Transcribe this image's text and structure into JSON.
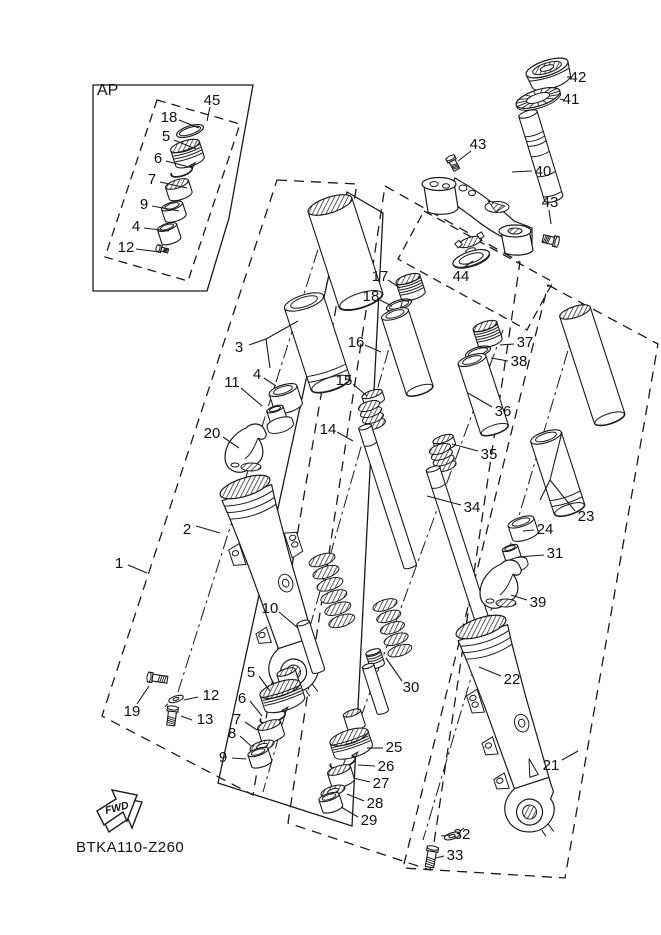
{
  "diagram": {
    "code": "BTKA110-Z260",
    "ap_label": "AP",
    "fwd_label": "FWD",
    "background_color": "#ffffff",
    "line_color": "#1a1a1a",
    "callouts": [
      {
        "n": "45",
        "x": 212,
        "y": 100,
        "leaders": [
          [
            210,
            107,
            207,
            121
          ]
        ]
      },
      {
        "n": "18",
        "x": 169,
        "y": 117,
        "leaders": [
          [
            179,
            120,
            199,
            128
          ]
        ]
      },
      {
        "n": "5",
        "x": 166,
        "y": 136,
        "leaders": [
          [
            174,
            140,
            196,
            149
          ]
        ]
      },
      {
        "n": "6",
        "x": 158,
        "y": 158,
        "leaders": [
          [
            166,
            161,
            193,
            168
          ]
        ]
      },
      {
        "n": "7",
        "x": 152,
        "y": 179,
        "leaders": [
          [
            160,
            182,
            187,
            188
          ]
        ]
      },
      {
        "n": "9",
        "x": 144,
        "y": 204,
        "leaders": [
          [
            152,
            206,
            179,
            211
          ]
        ]
      },
      {
        "n": "4",
        "x": 136,
        "y": 226,
        "leaders": [
          [
            144,
            228,
            169,
            231
          ]
        ]
      },
      {
        "n": "12",
        "x": 126,
        "y": 247,
        "leaders": [
          [
            136,
            249,
            160,
            252
          ]
        ]
      },
      {
        "n": "42",
        "x": 578,
        "y": 77,
        "leaders": [
          [
            567,
            77,
            572,
            77
          ]
        ]
      },
      {
        "n": "41",
        "x": 571,
        "y": 99,
        "leaders": [
          [
            560,
            99,
            564,
            100
          ]
        ]
      },
      {
        "n": "43",
        "x": 478,
        "y": 144,
        "leaders": [
          [
            471,
            151,
            458,
            161
          ]
        ]
      },
      {
        "n": "40",
        "x": 543,
        "y": 171,
        "leaders": [
          [
            532,
            171,
            512,
            172
          ]
        ]
      },
      {
        "n": "43",
        "x": 550,
        "y": 202,
        "leaders": [
          [
            549,
            210,
            551,
            224
          ]
        ]
      },
      {
        "n": "44",
        "x": 461,
        "y": 276,
        "leaders": [
          [
            463,
            268,
            473,
            261
          ]
        ]
      },
      {
        "n": "17",
        "x": 380,
        "y": 276,
        "leaders": [
          [
            388,
            280,
            400,
            288
          ]
        ]
      },
      {
        "n": "18",
        "x": 371,
        "y": 296,
        "leaders": [
          [
            380,
            300,
            392,
            306
          ]
        ]
      },
      {
        "n": "16",
        "x": 356,
        "y": 342,
        "leaders": [
          [
            365,
            345,
            381,
            352
          ]
        ]
      },
      {
        "n": "3",
        "x": 239,
        "y": 347,
        "leaders": [
          [
            249,
            345,
            266,
            339
          ],
          [
            266,
            339,
            298,
            321
          ],
          [
            266,
            339,
            270,
            368
          ]
        ]
      },
      {
        "n": "4",
        "x": 257,
        "y": 374,
        "leaders": [
          [
            264,
            378,
            276,
            386
          ]
        ]
      },
      {
        "n": "11",
        "x": 232,
        "y": 382,
        "leaders": [
          [
            241,
            388,
            262,
            406
          ]
        ]
      },
      {
        "n": "15",
        "x": 344,
        "y": 380,
        "leaders": [
          [
            353,
            384,
            367,
            396
          ]
        ]
      },
      {
        "n": "14",
        "x": 328,
        "y": 429,
        "leaders": [
          [
            337,
            432,
            353,
            441
          ]
        ]
      },
      {
        "n": "20",
        "x": 212,
        "y": 433,
        "leaders": [
          [
            223,
            437,
            239,
            448
          ]
        ]
      },
      {
        "n": "2",
        "x": 187,
        "y": 529,
        "leaders": [
          [
            196,
            526,
            220,
            533
          ]
        ]
      },
      {
        "n": "1",
        "x": 119,
        "y": 563,
        "leaders": [
          [
            128,
            565,
            147,
            573
          ]
        ]
      },
      {
        "n": "10",
        "x": 270,
        "y": 608,
        "leaders": [
          [
            279,
            612,
            298,
            628
          ]
        ]
      },
      {
        "n": "37",
        "x": 525,
        "y": 342,
        "leaders": [
          [
            514,
            344,
            500,
            345
          ]
        ]
      },
      {
        "n": "38",
        "x": 519,
        "y": 361,
        "leaders": [
          [
            508,
            361,
            491,
            358
          ]
        ]
      },
      {
        "n": "36",
        "x": 503,
        "y": 411,
        "leaders": [
          [
            492,
            407,
            468,
            393
          ]
        ]
      },
      {
        "n": "35",
        "x": 489,
        "y": 454,
        "leaders": [
          [
            478,
            451,
            452,
            444
          ]
        ]
      },
      {
        "n": "34",
        "x": 472,
        "y": 507,
        "leaders": [
          [
            461,
            505,
            427,
            496
          ]
        ]
      },
      {
        "n": "23",
        "x": 586,
        "y": 516,
        "leaders": [
          [
            575,
            511,
            550,
            480
          ],
          [
            550,
            480,
            562,
            432
          ],
          [
            550,
            480,
            540,
            500
          ]
        ]
      },
      {
        "n": "24",
        "x": 545,
        "y": 529,
        "leaders": [
          [
            534,
            530,
            523,
            531
          ]
        ]
      },
      {
        "n": "31",
        "x": 555,
        "y": 553,
        "leaders": [
          [
            544,
            555,
            518,
            557
          ]
        ]
      },
      {
        "n": "39",
        "x": 538,
        "y": 602,
        "leaders": [
          [
            527,
            600,
            511,
            595
          ]
        ]
      },
      {
        "n": "30",
        "x": 411,
        "y": 687,
        "leaders": [
          [
            402,
            681,
            386,
            658
          ]
        ]
      },
      {
        "n": "22",
        "x": 512,
        "y": 679,
        "leaders": [
          [
            501,
            676,
            479,
            667
          ]
        ]
      },
      {
        "n": "21",
        "x": 551,
        "y": 765,
        "leaders": [
          [
            562,
            760,
            578,
            751
          ]
        ]
      },
      {
        "n": "25",
        "x": 394,
        "y": 747,
        "leaders": [
          [
            383,
            748,
            367,
            748
          ]
        ]
      },
      {
        "n": "26",
        "x": 386,
        "y": 766,
        "leaders": [
          [
            375,
            766,
            358,
            765
          ]
        ]
      },
      {
        "n": "27",
        "x": 381,
        "y": 783,
        "leaders": [
          [
            370,
            782,
            353,
            778
          ]
        ]
      },
      {
        "n": "28",
        "x": 375,
        "y": 803,
        "leaders": [
          [
            364,
            801,
            347,
            794
          ]
        ]
      },
      {
        "n": "29",
        "x": 369,
        "y": 820,
        "leaders": [
          [
            358,
            817,
            341,
            807
          ]
        ]
      },
      {
        "n": "5",
        "x": 251,
        "y": 672,
        "leaders": [
          [
            259,
            676,
            270,
            691
          ]
        ]
      },
      {
        "n": "6",
        "x": 242,
        "y": 698,
        "leaders": [
          [
            250,
            701,
            262,
            716
          ]
        ]
      },
      {
        "n": "7",
        "x": 237,
        "y": 719,
        "leaders": [
          [
            245,
            722,
            257,
            730
          ]
        ]
      },
      {
        "n": "8",
        "x": 232,
        "y": 733,
        "leaders": [
          [
            240,
            736,
            251,
            746
          ]
        ]
      },
      {
        "n": "9",
        "x": 223,
        "y": 757,
        "leaders": [
          [
            232,
            758,
            246,
            759
          ]
        ]
      },
      {
        "n": "19",
        "x": 132,
        "y": 711,
        "leaders": [
          [
            137,
            704,
            149,
            686
          ]
        ]
      },
      {
        "n": "12",
        "x": 211,
        "y": 695,
        "leaders": [
          [
            198,
            697,
            184,
            700
          ]
        ]
      },
      {
        "n": "13",
        "x": 205,
        "y": 719,
        "leaders": [
          [
            192,
            720,
            181,
            716
          ]
        ]
      },
      {
        "n": "32",
        "x": 462,
        "y": 834,
        "leaders": [
          [
            451,
            835,
            441,
            836
          ]
        ]
      },
      {
        "n": "33",
        "x": 455,
        "y": 855,
        "leaders": [
          [
            444,
            856,
            436,
            858
          ]
        ]
      }
    ]
  }
}
